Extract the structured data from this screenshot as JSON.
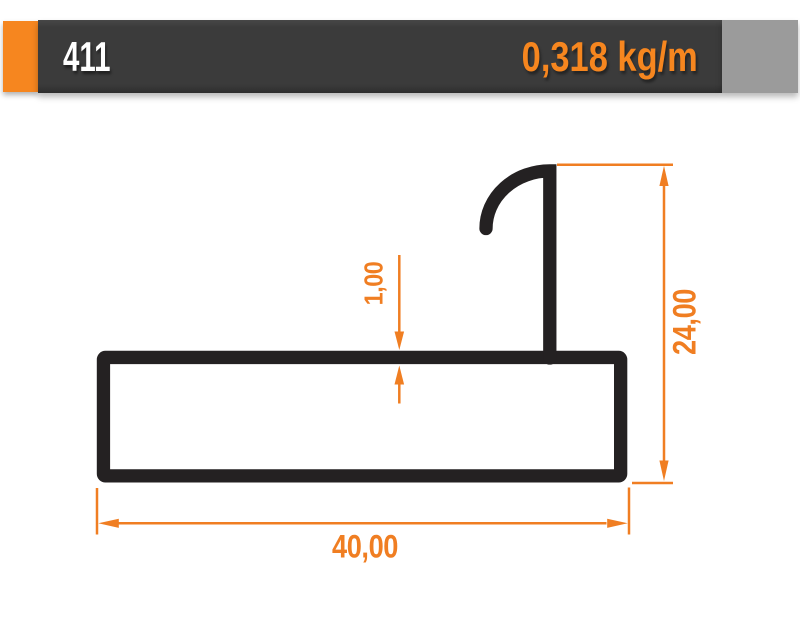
{
  "header": {
    "profile_number": "411",
    "weight_per_meter": "0,318 kg/m"
  },
  "drawing": {
    "labels": {
      "width_mm": "40,00",
      "total_height_mm": "24,00",
      "wall_thickness_mm": "1,00"
    }
  },
  "colors": {
    "accent": "#F6861F",
    "bar-dark": "#3B3B3B",
    "endcap-gray": "#9B9B9B",
    "profile-black": "#242122",
    "dimension-orange": "#F07E22",
    "number-white": "#FFFFFF",
    "page-bg": "#FFFFFF"
  }
}
